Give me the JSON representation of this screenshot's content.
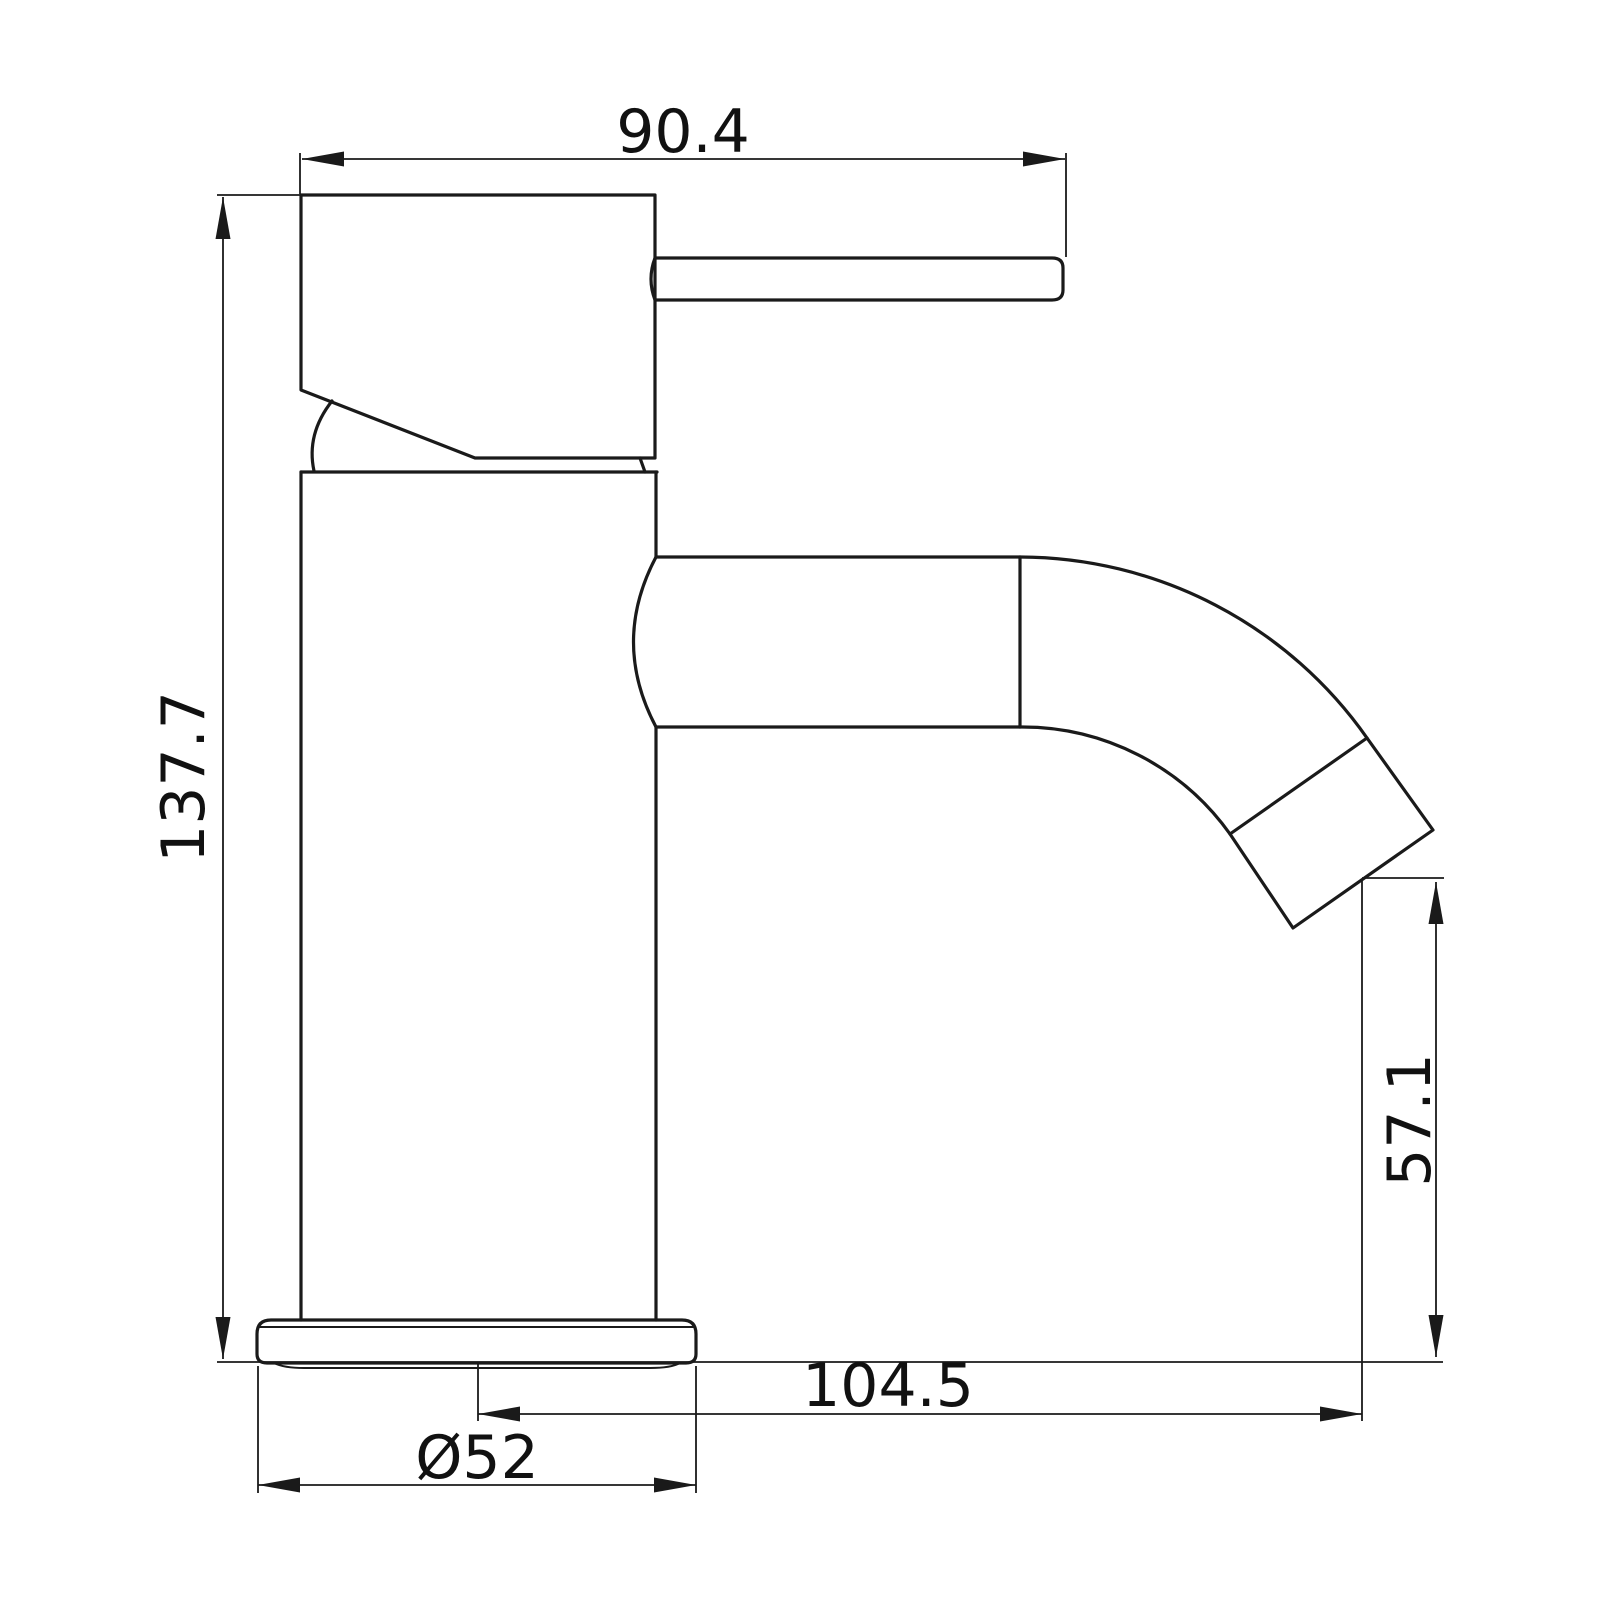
{
  "drawing": {
    "type": "technical-dimension-drawing",
    "subject": "single-lever basin mixer tap, side elevation",
    "background": "#ffffff",
    "line_color": "#1a1a1a",
    "labels": {
      "handle_reach_top": "90.4",
      "overall_height": "137.7",
      "spout_reach": "104.5",
      "spout_outlet_height": "57.1",
      "base_diameter": "Ø52"
    }
  }
}
